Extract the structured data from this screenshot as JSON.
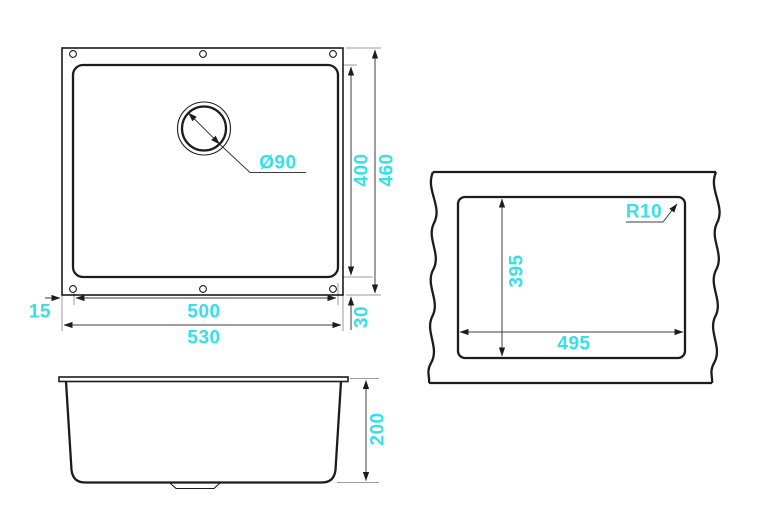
{
  "drawing": {
    "background": "#ffffff",
    "line_color": "#1c1c1c",
    "dim_line_color": "#3c3c3c",
    "ext_line_color": "#9b9b9b",
    "arrow_color": "#1c1c1c",
    "accent_color": "#35e0e9",
    "top_view": {
      "labels": {
        "drain_diameter": "Ø90",
        "bowl_height": "400",
        "overall_height": "460",
        "bowl_width": "500",
        "overall_width": "530",
        "rim_side": "15",
        "rim_bottom": "30"
      }
    },
    "cutout_view": {
      "labels": {
        "corner_radius": "R10",
        "cutout_height": "395",
        "cutout_width": "495"
      }
    },
    "side_view": {
      "labels": {
        "depth": "200"
      }
    }
  }
}
